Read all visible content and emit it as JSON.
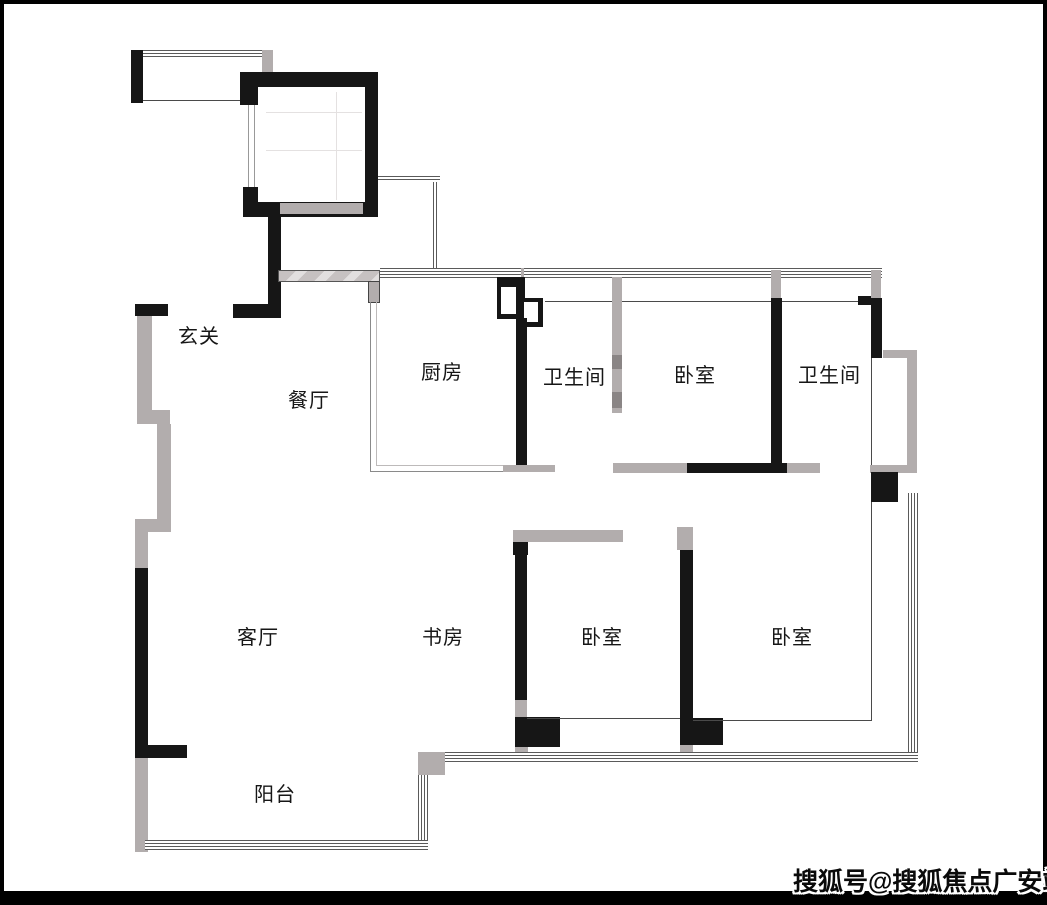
{
  "rooms": {
    "entry": {
      "label": "玄关"
    },
    "dining": {
      "label": "餐厅"
    },
    "kitchen": {
      "label": "厨房"
    },
    "bath_1": {
      "label": "卫生间"
    },
    "bed_1": {
      "label": "卧室"
    },
    "bath_2": {
      "label": "卫生间"
    },
    "living": {
      "label": "客厅"
    },
    "study": {
      "label": "书房"
    },
    "bed_2": {
      "label": "卧室"
    },
    "bed_3": {
      "label": "卧室"
    },
    "balcony": {
      "label": "阳台"
    }
  },
  "watermark": {
    "text": "搜狐号@搜狐焦点广安站"
  },
  "colors": {
    "wall_black": "#161616",
    "wall_gray": "#b2adad",
    "window_line": "#5a5a5a",
    "background": "#ffffff"
  }
}
